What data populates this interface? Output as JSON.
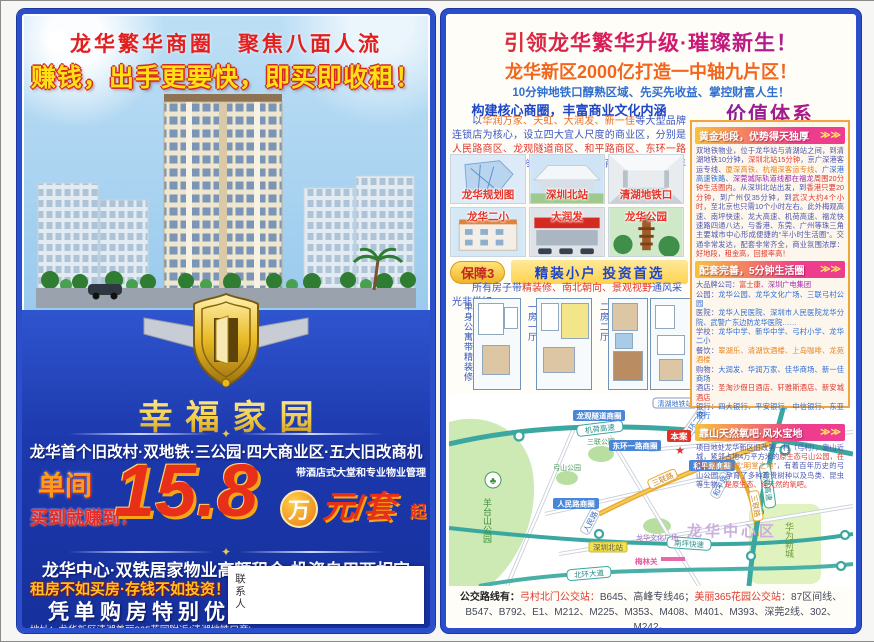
{
  "icons": {
    "sun": "✹",
    "ornament": "✦",
    "arrows": "≫≫",
    "star": "★",
    "tree": "♣"
  },
  "left_page": {
    "slogan1": "龙华繁华商圈　聚焦八面人流",
    "slogan2": "赚钱，出手更要快，即买即收租！",
    "project_name": "幸福家园",
    "selling_points": "龙华首个旧改村·双地铁·三公园·四大商业区·五大旧改商机",
    "unit_label": "单间",
    "buy_label": "买到就赚到！",
    "price_number": "15.8",
    "price_wan": "万",
    "price_unit": "元/套",
    "price_qi": "起",
    "price_note": "带酒店式大堂和专业物业管理",
    "line2": "龙华中心·双铁居家物业高额租金·投资自用两相宜",
    "line3": "租房不如买房·存钱不如投资！",
    "line4": "凭单购房特别优惠",
    "address": "地址：龙华新区清湖美丽365花园附近(清湖地铁口旁)",
    "contact_label": "联系人"
  },
  "right_page": {
    "headline": "引领龙华繁华升级·璀璨新生！",
    "subheadline": "龙华新区2000亿打造一中轴九片区！",
    "tagline": "10分钟地铁口醇熟区域、先买先收益、掌控财富人生！",
    "left_col": {
      "header": "构建核心商圈，丰富商业文化内涵",
      "paragraph": [
        {
          "t": "以",
          "c": "#3a56c4"
        },
        {
          "t": "华润万家、天虹、大润发、新一佳",
          "c": "#e8702a"
        },
        {
          "t": "等大型品牌连锁店为核心，设立四大宜人尺度的商业区，分别是",
          "c": "#3a56c4"
        },
        {
          "t": "人民路商区、龙观隧道商区、和平路商区、东环一路商区",
          "c": "#e0372e"
        },
        {
          "t": "，形成不同档次和辐射范围的商业层级，满足年轻人的消费需求。",
          "c": "#3a56c4"
        }
      ],
      "photos": [
        {
          "caption": "龙华规划图"
        },
        {
          "caption": "深圳北站"
        },
        {
          "caption": "清湖地铁口"
        },
        {
          "caption": "龙华二小"
        },
        {
          "caption": "大润发"
        },
        {
          "caption": "龙华公园"
        }
      ],
      "badge": "保障3",
      "badge_title": "精装小户 投资首选",
      "badge_paragraph": [
        {
          "t": "所有房子带",
          "c": "#3a56c4"
        },
        {
          "t": "精装修、南北朝向、景观视野",
          "c": "#e0372e"
        },
        {
          "t": "通风采光非常好。",
          "c": "#3a56c4"
        }
      ],
      "floorplans": [
        {
          "label": "单身公寓带精装修"
        },
        {
          "label": "一房一厅"
        },
        {
          "label": "二房二厅"
        }
      ]
    },
    "value_col": {
      "title": "价值体系",
      "sections": [
        {
          "header": "黄金地段，优势得天独厚",
          "body": [
            {
              "t": "双地铁物业，位于龙华站与清湖站之间，到清湖地铁10分钟，",
              "c": "#4a55b0"
            },
            {
              "t": "深圳北站15分钟",
              "c": "#e0372e"
            },
            {
              "t": "，京广深港客运专线、",
              "c": "#4a55b0"
            },
            {
              "t": "厦深高铁、杭福深客运专线",
              "c": "#e8821e"
            },
            {
              "t": "、广深港高速铁路、",
              "c": "#2b6bd4"
            },
            {
              "t": "深莞城际轨道线都在福龙",
              "c": "#9c27b0"
            },
            {
              "t": "周围20分钟生活圈内",
              "c": "#e0372e"
            },
            {
              "t": "。从深圳北站出发，到",
              "c": "#4a55b0"
            },
            {
              "t": "香港只要20分钟",
              "c": "#e0372e"
            },
            {
              "t": "，到广州仅35分钟，到",
              "c": "#4a55b0"
            },
            {
              "t": "武汉大约4个小时",
              "c": "#e0372e"
            },
            {
              "t": "，至北京也只需10个小时左右。此外梅观高速、南坪快速、龙大高速、机荷高速、福龙快速路四通八达，与香港、东莞、广州等珠三角主要城市中心形成便捷的“半小时生活圈”。交通非常发达，配套非常齐全，商业氛围浓厚：",
              "c": "#4a55b0"
            },
            {
              "t": "好地段，租金高，回报率高！",
              "c": "#e0372e"
            }
          ]
        },
        {
          "header": "配套完善，5分钟生活圈",
          "body": [
            {
              "t": "大品牌公司：",
              "c": "#4a55b0"
            },
            {
              "t": "富士康",
              "c": "#e0372e"
            },
            {
              "t": "、深圳广电集团\n",
              "c": "#9c27b0"
            },
            {
              "t": "公园：",
              "c": "#4a55b0"
            },
            {
              "t": "龙华公园、龙华文化广场、三联弓村公园\n",
              "c": "#2b6bd4"
            },
            {
              "t": "医院：",
              "c": "#4a55b0"
            },
            {
              "t": "龙华人民医院、深圳市人民医院龙华分院、武警广东边防龙华医院……\n",
              "c": "#2b6bd4"
            },
            {
              "t": "学校：",
              "c": "#4a55b0"
            },
            {
              "t": "龙华中学、新华中学、弓村小学、龙华二小\n",
              "c": "#2b6bd4"
            },
            {
              "t": "餐饮：",
              "c": "#4a55b0"
            },
            {
              "t": "翠湖乐、清湖饮酒楼、上岛咖啡、龙苑酒楼\n",
              "c": "#e8821e"
            },
            {
              "t": "购物：",
              "c": "#4a55b0"
            },
            {
              "t": "大润发、华润万家、佳华商场、新一佳商场\n",
              "c": "#2b6bd4"
            },
            {
              "t": "酒店：",
              "c": "#4a55b0"
            },
            {
              "t": "圣淘沙假日酒店、轩雅斯酒店、新安城酒店\n",
              "c": "#e0372e"
            },
            {
              "t": "银行：",
              "c": "#4a55b0"
            },
            {
              "t": "四大银行、平安银行、中信银行、东亚银行",
              "c": "#2b6bd4"
            }
          ]
        },
        {
          "header": "靠山天然氧吧·风水宝地",
          "body": [
            {
              "t": "项目地处龙华新区旧改第一村（弓村），靠山近城，紧邻占地4万平方米的",
              "c": "#4a55b0"
            },
            {
              "t": "原生态弓山公园，在风",
              "c": "#e0372e"
            },
            {
              "t": "水学上形成“明堂之地”",
              "c": "#e8821e"
            },
            {
              "t": "，有着百年历史的弓山公园，孕育了多种珍贵树种以及鸟类、昆虫等生物，",
              "c": "#4a55b0"
            },
            {
              "t": "是原生态、纯天然的氧吧。",
              "c": "#e0372e"
            }
          ]
        }
      ]
    },
    "map": {
      "highway1": "机荷高速",
      "highway2": "梅观高速",
      "expwy1": "南坪快速",
      "expwy2": "北环大道",
      "road_sanlian": "三联路",
      "park_yangtai": "羊台山公园",
      "park_sanlian": "三联公园",
      "park_gongshan": "弓山公园",
      "zone_huawei": "华为新城",
      "district": "龙华中心区",
      "biz_longguan": "龙观隧道商圈",
      "biz_donghuan": "东环一路商圈",
      "biz_renmin": "人民路商圈",
      "biz_heping": "和平路商圈",
      "site": "本案",
      "station": "深圳北站",
      "checkpoint": "梅林关",
      "plaza": "龙华文化广场",
      "metro": "清湖地铁站",
      "road_pill1": "东环二路",
      "road_pill2": "人民路",
      "road_pill3": "和平路"
    },
    "bus_routes": [
      {
        "t": "公交路线有：",
        "c": "#222222",
        "b": true
      },
      {
        "t": "弓村北门公交站：",
        "c": "#e0372e"
      },
      {
        "t": "B645、高峰专线46；",
        "c": "#44485a"
      },
      {
        "t": "美丽365花园公交站：",
        "c": "#e0372e"
      },
      {
        "t": "87区间线、B547、B792、E1、M212、M225、M353、M408、M401、M393、深莞2线、302、M242。",
        "c": "#44485a"
      }
    ]
  }
}
